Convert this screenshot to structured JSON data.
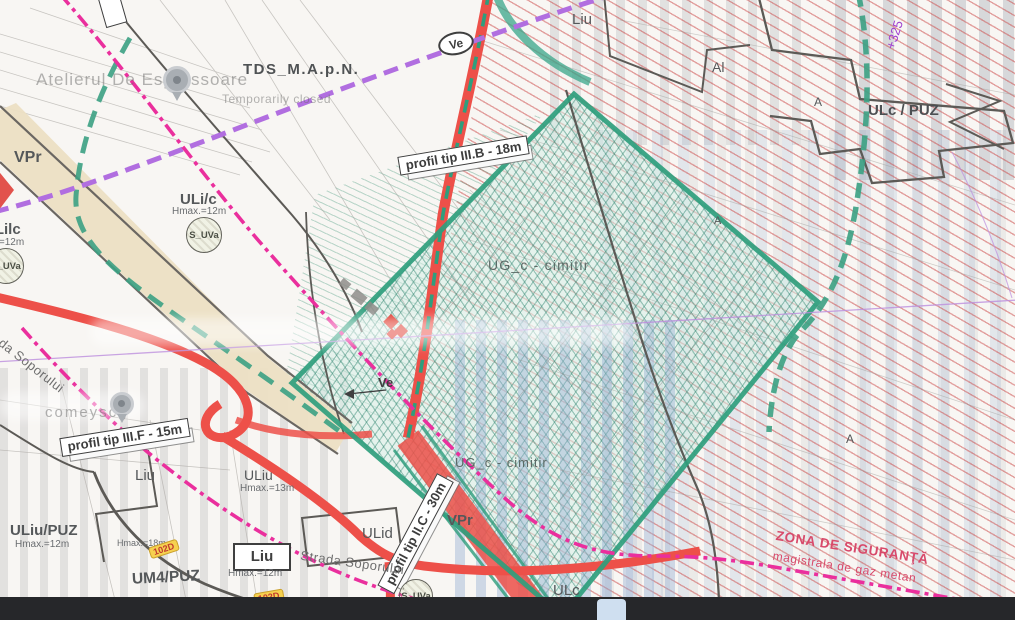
{
  "labels": {
    "tds": "TDS_M.A.p.N.",
    "vpr": "VPr",
    "ulic": "ULi/c",
    "ulic_hmax": "Hmax.=12m",
    "ulilc": "ULilc",
    "ulilc_hmax": "Hmax.=12m",
    "suva": "S_UVa",
    "liu": "Liu",
    "al": "Al",
    "a": "A",
    "ulc_puz": "ULc / PUZ",
    "elevation": "+325",
    "ve": "Ve",
    "ug_cimitir": "UG_c - cimitir",
    "uliu": "ULiu",
    "uliu_hmax": "Hmax.=13m",
    "uliu_puz": "ULiu/PUZ",
    "uliu_puz_hmax": "Hmax.=12m",
    "hmax18": "Hmax.=18m",
    "um4_puz": "UM4/PUZ",
    "liu_box_hmax": "Hmax.=12m",
    "ulid": "ULid",
    "ulc": "ULc"
  },
  "profiles": {
    "iiib": "profil tip III.B - 18m",
    "iiif": "profil tip III.F - 15m",
    "iic": "profil tip II.C - 30m"
  },
  "streets": {
    "soporului": "Strada Soporului"
  },
  "badges": {
    "road_code": "102D"
  },
  "safety_zone": {
    "title": "ZONA DE SIGURANŢĂ",
    "subtitle": "magistrala de gaz metan"
  },
  "watermarks": {
    "place": "Atelierul De Espressoare",
    "status": "Temporarily closed",
    "partial": "comeyscg"
  },
  "colors": {
    "road_red": "#ed5049",
    "hatch_red": "#cc4a4a",
    "cemetery_teal": "#2f9e7d",
    "green_dashed": "#3ba183",
    "pipeline_magenta": "#ea2f9d",
    "boundary_purple": "#b16ee0",
    "corridor_tan": "#ecdfc3",
    "safety_text": "#d84a6b",
    "badge_yellow": "#f6d14f"
  }
}
